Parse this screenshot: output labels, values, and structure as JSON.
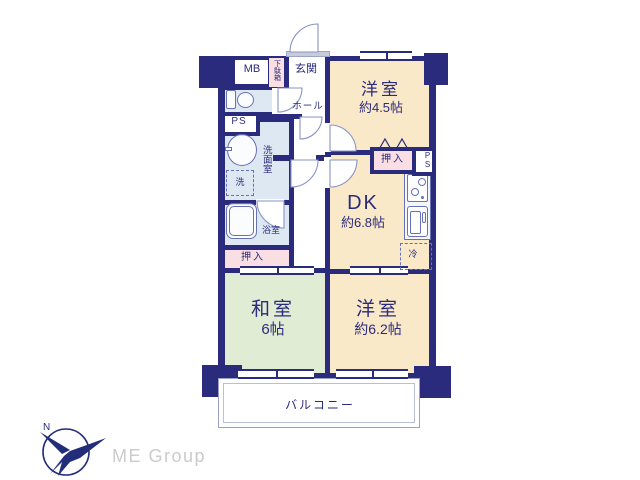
{
  "colors": {
    "wall_navy": "#2b2b7d",
    "room_beige": "#f9e9c8",
    "tatami_green": "#e0ecd3",
    "wet_area_blue": "#dde8f3",
    "closet_pink": "#f9dfe4",
    "balcony_line": "#99a1c9",
    "fixture_blue": "#6672b3",
    "logo_navy": "#232e7a",
    "logo_text_gray": "#cbcbcb"
  },
  "plan": {
    "rooms": {
      "western_room_1": {
        "label": "洋室",
        "size": "約4.5帖"
      },
      "dk": {
        "label": "DK",
        "size": "約6.8帖"
      },
      "japanese_room": {
        "label": "和室",
        "size": "6帖"
      },
      "western_room_2": {
        "label": "洋室",
        "size": "約6.2帖"
      },
      "balcony": {
        "label": "バルコニー"
      },
      "entrance": {
        "label": "玄関"
      },
      "hall": {
        "label": "ホール"
      },
      "washroom": {
        "label": "洗面室"
      },
      "bathroom": {
        "label": "浴室"
      },
      "closet_left": {
        "label": "押入"
      },
      "closet_right": {
        "label": "押入"
      },
      "shoe_cabinet": {
        "label": "下駄箱"
      },
      "meter_box": {
        "label": "MB"
      },
      "pipe_space_left": {
        "label": "PS"
      },
      "pipe_space_right": {
        "label": "PS"
      },
      "washer_space": {
        "label": "洗"
      },
      "refrigerator_space": {
        "label": "冷"
      }
    }
  },
  "logo": {
    "mark": "N",
    "text": "ME Group"
  }
}
